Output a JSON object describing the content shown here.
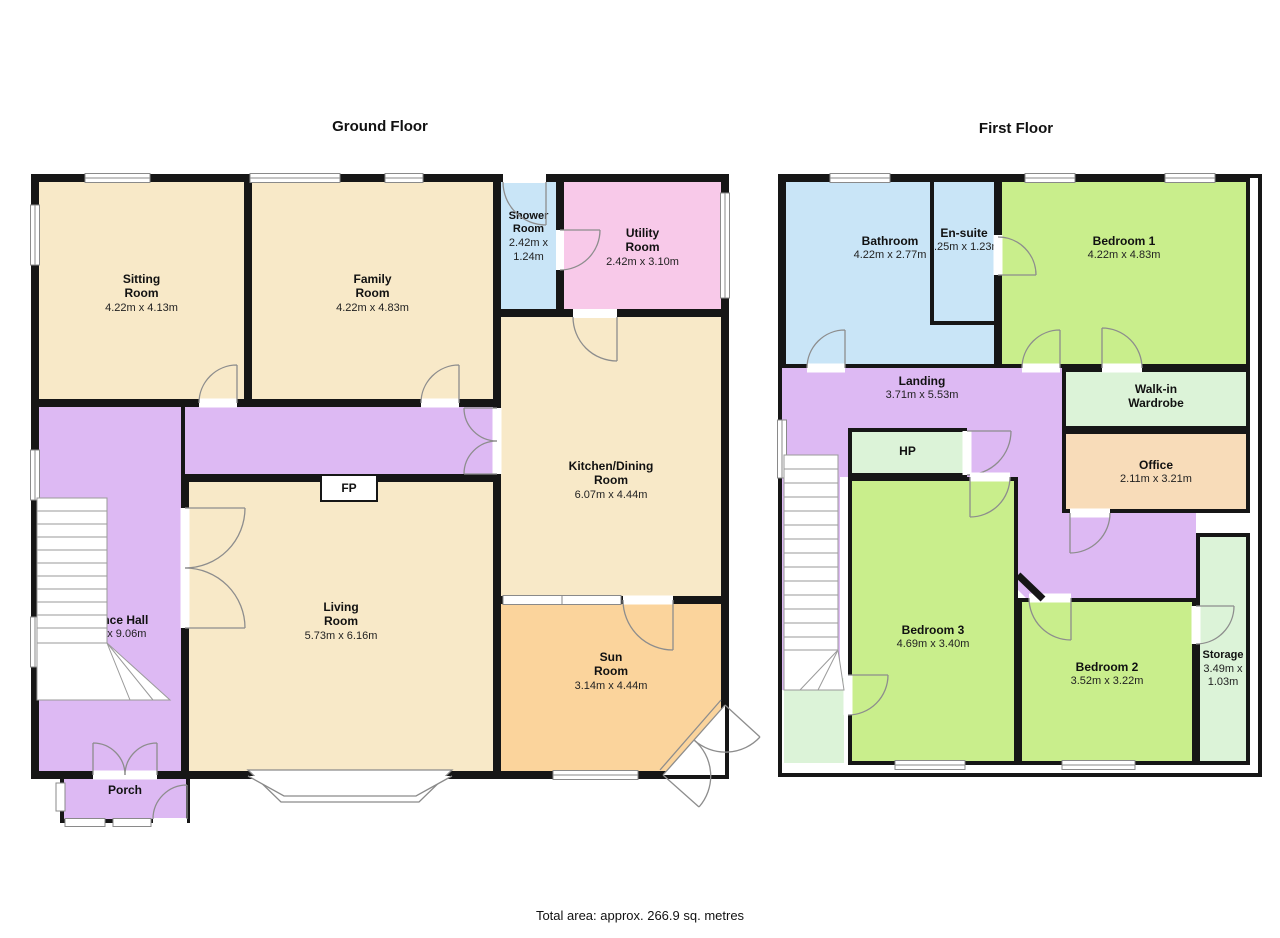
{
  "ground_floor": {
    "title": "Ground Floor",
    "rooms": {
      "sitting": {
        "name": "Sitting Room",
        "dims": "4.22m x 4.13m"
      },
      "family": {
        "name": "Family Room",
        "dims": "4.22m x 4.83m"
      },
      "shower": {
        "name": "Shower Room",
        "dims": "2.42m x 1.24m"
      },
      "utility": {
        "name": "Utility Room",
        "dims": "2.42m x 3.10m"
      },
      "kitchen": {
        "name": "Kitchen/Dining Room",
        "dims": "6.07m x 4.44m"
      },
      "entrance_hall": {
        "name": "Entrance Hall",
        "dims": "7.33m x 9.06m"
      },
      "living": {
        "name": "Living Room",
        "dims": "5.73m x 6.16m"
      },
      "sun": {
        "name": "Sun Room",
        "dims": "3.14m x 4.44m"
      },
      "porch": {
        "name": "Porch"
      },
      "fireplace": {
        "label": "FP"
      }
    }
  },
  "first_floor": {
    "title": "First Floor",
    "rooms": {
      "bathroom": {
        "name": "Bathroom",
        "dims": "4.22m x 2.77m"
      },
      "ensuite": {
        "name": "En-suite",
        "dims": ".25m x 1.23m"
      },
      "bedroom1": {
        "name": "Bedroom 1",
        "dims": "4.22m x 4.83m"
      },
      "landing": {
        "name": "Landing",
        "dims": "3.71m x 5.53m"
      },
      "wardrobe": {
        "name": "Walk-in Wardrobe"
      },
      "hot_press": {
        "label": "HP"
      },
      "office": {
        "name": "Office",
        "dims": "2.11m x 3.21m"
      },
      "bedroom3": {
        "name": "Bedroom 3",
        "dims": "4.69m x 3.40m"
      },
      "bedroom2": {
        "name": "Bedroom 2",
        "dims": "3.52m x 3.22m"
      },
      "storage": {
        "name": "Storage",
        "dims": "3.49m x 1.03m"
      }
    }
  },
  "footer": {
    "total_area": "Total area: approx. 266.9 sq. metres"
  },
  "colors": {
    "wall": "#161616",
    "cream": "#F8E9C8",
    "purple": "#DDB9F3",
    "blue": "#C9E5F7",
    "pink": "#F8C9E9",
    "orange": "#FBD49C",
    "green": "#C9EE8C",
    "mint": "#DCF3D8",
    "peach": "#F8DCB9"
  }
}
